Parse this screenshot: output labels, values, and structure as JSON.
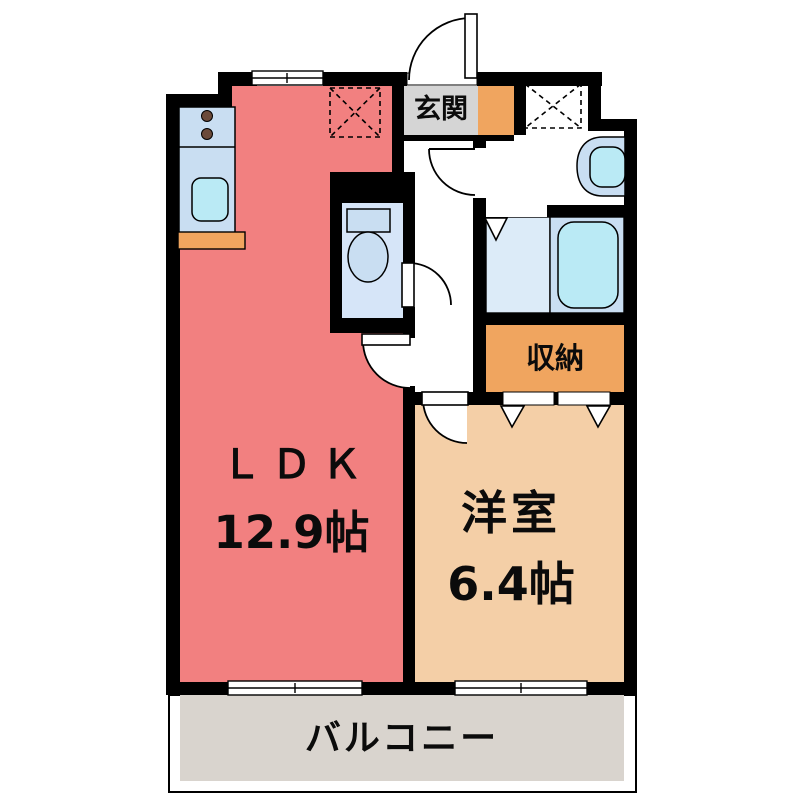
{
  "plan_title": "1LDK floor plan",
  "rooms": {
    "ldk": {
      "label": "ＬＤＫ",
      "size": "12.9帖"
    },
    "western_room": {
      "label": "洋室",
      "size": "6.4帖"
    },
    "entrance": {
      "label": "玄関"
    },
    "storage": {
      "label": "収納"
    },
    "balcony": {
      "label": "バルコニー"
    }
  },
  "icons": {
    "kitchen": [
      "stove-burners-icon",
      "kitchen-sink-icon",
      "counter-shelf-icon"
    ],
    "sanitary": [
      "toilet-icon",
      "washbasin-icon",
      "bathtub-icon"
    ],
    "placement_boxes": [
      "refrigerator-place-icon",
      "washer-place-icon"
    ],
    "openings": [
      "entrance-door-swing",
      "washroom-door-swing",
      "toilet-door-swing",
      "ldk-door-swing",
      "western-room-door-swing",
      "closet-folding-doors",
      "bath-folding-door",
      "kitchen-window",
      "balcony-windows"
    ]
  },
  "colors": {
    "wall-black": "#000000",
    "ldk-pink": "#f28080",
    "room-peach": "#f4cfa7",
    "accent-orange": "#f0a55f",
    "entrance-gray": "#d5d5d5",
    "balcony-gray": "#d9d4ce",
    "toilet-blue": "#d6e5f8",
    "bath-blue": "#dcebf8",
    "fixture-blue": "#c9def2",
    "fixture-cyan": "#baeaf5",
    "burner-brown": "#6b4a3a"
  }
}
